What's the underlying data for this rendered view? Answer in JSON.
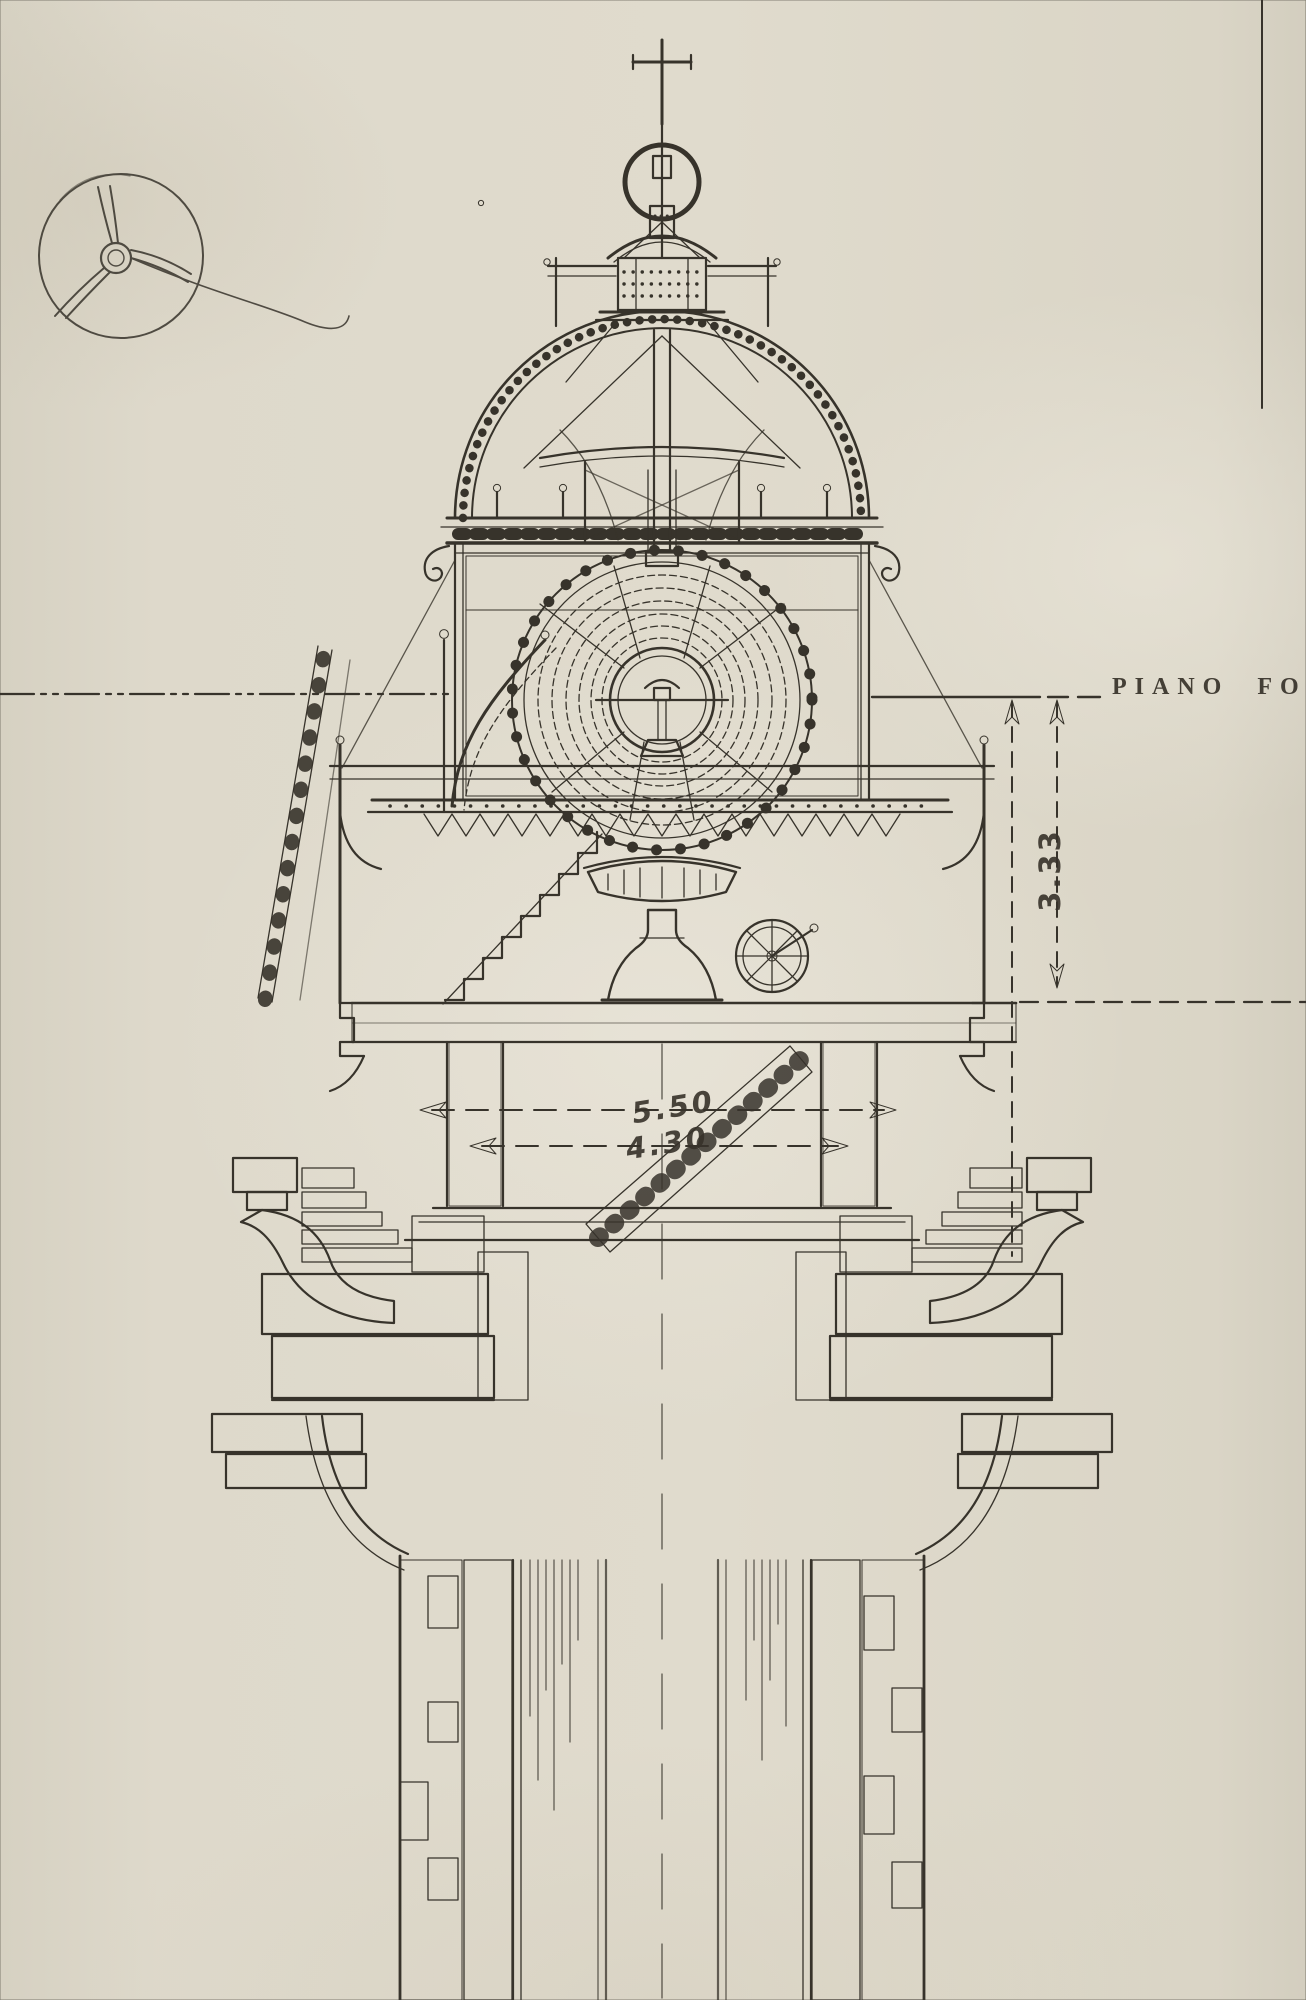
{
  "drawing": {
    "type": "lighthouse lantern cross-section, ink on aged paper",
    "labels": {
      "focal_plane": "PIANO  FO",
      "dim_vertical": "3.33",
      "dim_outer_width": "5.50",
      "dim_inner_width": "4.30"
    },
    "colors": {
      "paper": "#dcd7c9",
      "ink": "#37332b",
      "pencil": "#8f897a",
      "watermark": "#efece1"
    },
    "icons": {
      "watermark": "shield-crest-watermark",
      "sketch": "pencil-propeller-sketch"
    }
  }
}
